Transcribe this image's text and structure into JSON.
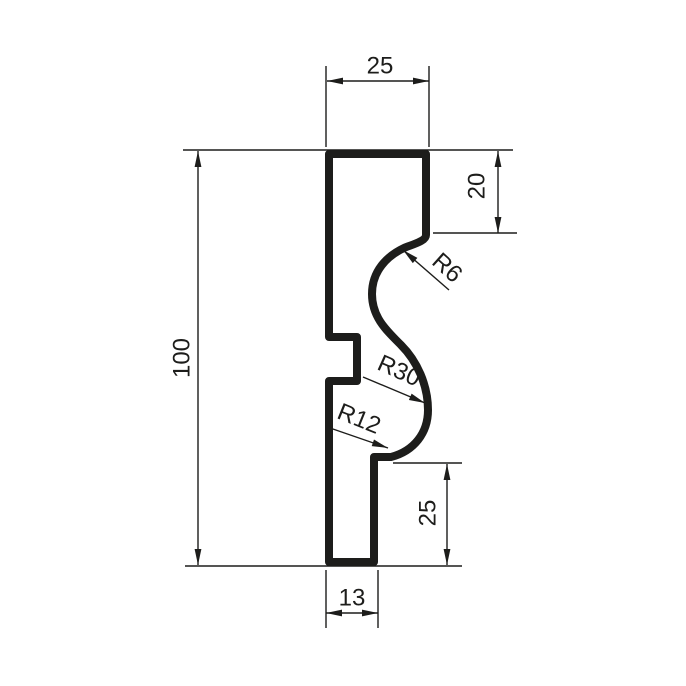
{
  "drawing": {
    "description": "Moulding profile cross-section, CAD technical drawing",
    "colors": {
      "ink": "#1d1d1b",
      "background": "#ffffff"
    },
    "dims": {
      "top_width": "25",
      "upper_right_height": "20",
      "overall_height": "100",
      "lower_right_height": "25",
      "bottom_width": "13"
    },
    "radii": {
      "top_cove": "R6",
      "middle_sweep": "R30",
      "bottom_cove": "R12"
    }
  }
}
